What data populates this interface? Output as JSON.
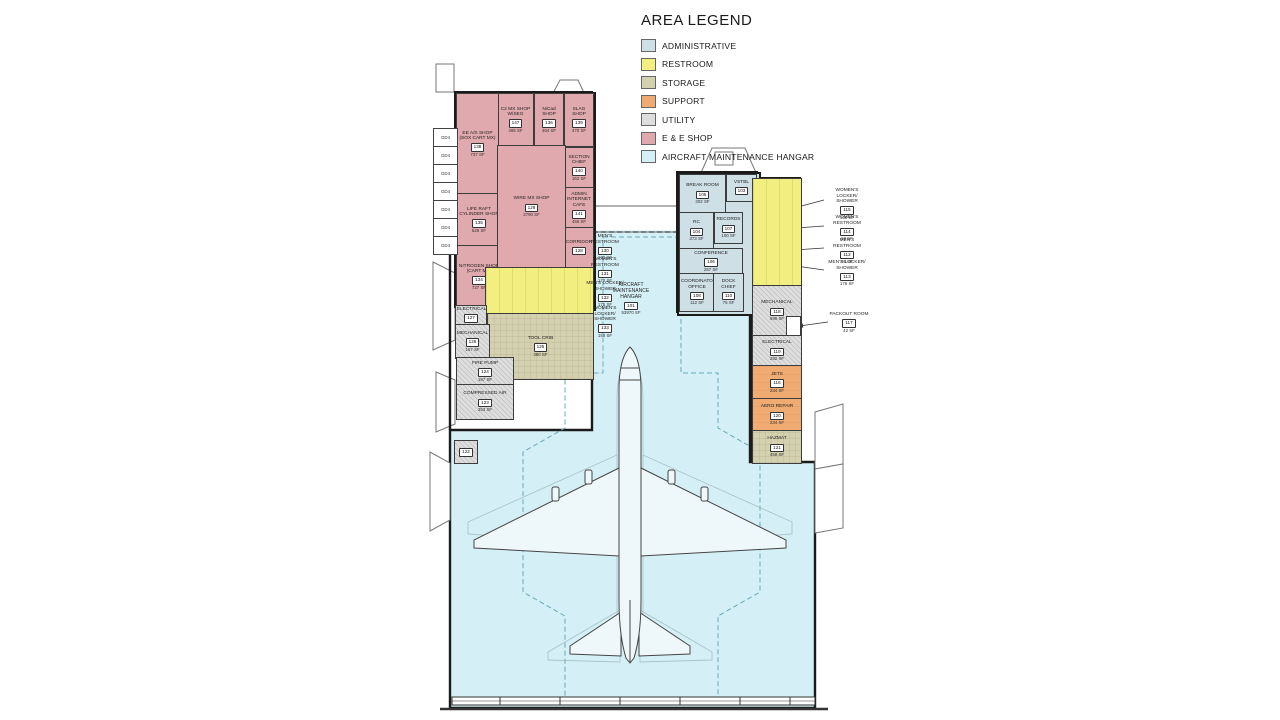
{
  "legend": {
    "title": "AREA LEGEND",
    "entries": [
      {
        "label": "ADMINISTRATIVE",
        "color": "#cfdfe6"
      },
      {
        "label": "RESTROOM",
        "color": "#f2ee7f"
      },
      {
        "label": "STORAGE",
        "color": "#d4d1b0"
      },
      {
        "label": "SUPPORT",
        "color": "#efab72"
      },
      {
        "label": "UTILITY",
        "color": "#dedede"
      },
      {
        "label": "E & E SHOP",
        "color": "#e0a9ad"
      },
      {
        "label": "AIRCRAFT MAINTENANCE HANGAR",
        "color": "#d4f0f6"
      }
    ]
  },
  "hangar": {
    "name": "AIRCRAFT MAINTENANCE HANGAR",
    "number": "101",
    "area": "53970 SF"
  },
  "west_module_label": "GD4",
  "rooms": [
    {
      "name": "C2 MX SHOP W/SEG",
      "number": "147",
      "area": "465 SF"
    },
    {
      "name": "NiCad SHOP",
      "number": "136",
      "area": "464 SF"
    },
    {
      "name": "SLAG SHOP",
      "number": "139",
      "area": "470 SF"
    },
    {
      "name": "SECTION CHIEF",
      "number": "140",
      "area": "162 SF"
    },
    {
      "name": "ADMIN INTERNET CAFE",
      "number": "141",
      "area": "456 SF"
    },
    {
      "name": "CORRIDOR",
      "number": "128",
      "area": ""
    },
    {
      "name": "EE A/S SHOP (SOX CART MX)",
      "number": "138",
      "area": "737 SF"
    },
    {
      "name": "LIFE RAFT CYLINDER SHOP",
      "number": "135",
      "area": "526 SF"
    },
    {
      "name": "NITROGEN SHOP (CART MX)",
      "number": "134",
      "area": "727 SF"
    },
    {
      "name": "WIRE MX SHOP",
      "number": "129",
      "area": "2790 SF"
    },
    {
      "name": "BREAK ROOM",
      "number": "105",
      "area": "302 SF"
    },
    {
      "name": "VSTBL",
      "number": "103",
      "area": ""
    },
    {
      "name": "RC",
      "number": "104",
      "area": "373 SF"
    },
    {
      "name": "RECORDS",
      "number": "107",
      "area": "100 SF"
    },
    {
      "name": "CONFERENCE",
      "number": "106",
      "area": "257 SF"
    },
    {
      "name": "COORDINATOR OFFICE",
      "number": "108",
      "area": "112 SF"
    },
    {
      "name": "DOCK CHIEF",
      "number": "110",
      "area": "75 SF"
    },
    {
      "name": "ELECTRICAL",
      "number": "127",
      "area": "70 SF"
    },
    {
      "name": "MECHANICAL",
      "number": "126",
      "area": "167 SF"
    },
    {
      "name": "FIRE PUMP",
      "number": "124",
      "area": "187 SF"
    },
    {
      "name": "COMPRESSED AIR",
      "number": "123",
      "area": "353 SF"
    },
    {
      "name": "TOOL CRIB",
      "number": "125",
      "area": "380 SF"
    },
    {
      "name": "MECHANICAL",
      "number": "118",
      "area": "599 SF"
    },
    {
      "name": "ELECTRICAL",
      "number": "119",
      "area": "292 SF"
    },
    {
      "name": "JETS",
      "number": "116",
      "area": "234 SF"
    },
    {
      "name": "AERO REPAIR",
      "number": "120",
      "area": "234 SF"
    },
    {
      "name": "HAZMAT",
      "number": "121",
      "area": "458 SF"
    },
    {
      "name": "",
      "number": "122",
      "area": ""
    }
  ],
  "callouts": {
    "left": [
      {
        "name": "MEN'S RESTROOM",
        "number": "130",
        "area": "170 SF"
      },
      {
        "name": "WOMEN'S RESTROOM",
        "number": "131",
        "area": "170 SF"
      },
      {
        "name": "MEN'S LOCKER/ SHOWER",
        "number": "132",
        "area": "175 SF"
      },
      {
        "name": "WOMEN'S LOCKER/ SHOWER",
        "number": "133",
        "area": "158 SF"
      }
    ],
    "right": [
      {
        "name": "WOMEN'S LOCKER/ SHOWER",
        "number": "115",
        "area": "138 SF"
      },
      {
        "name": "WOMEN'S RESTROOM",
        "number": "114",
        "area": "98 SF"
      },
      {
        "name": "MEN'S RESTROOM",
        "number": "112",
        "area": "98 SF"
      },
      {
        "name": "MEN'S LOCKER/ SHOWER",
        "number": "113",
        "area": "176 SF"
      },
      {
        "name": "PACKOUT ROOM",
        "number": "117",
        "area": "42 SF"
      }
    ]
  }
}
